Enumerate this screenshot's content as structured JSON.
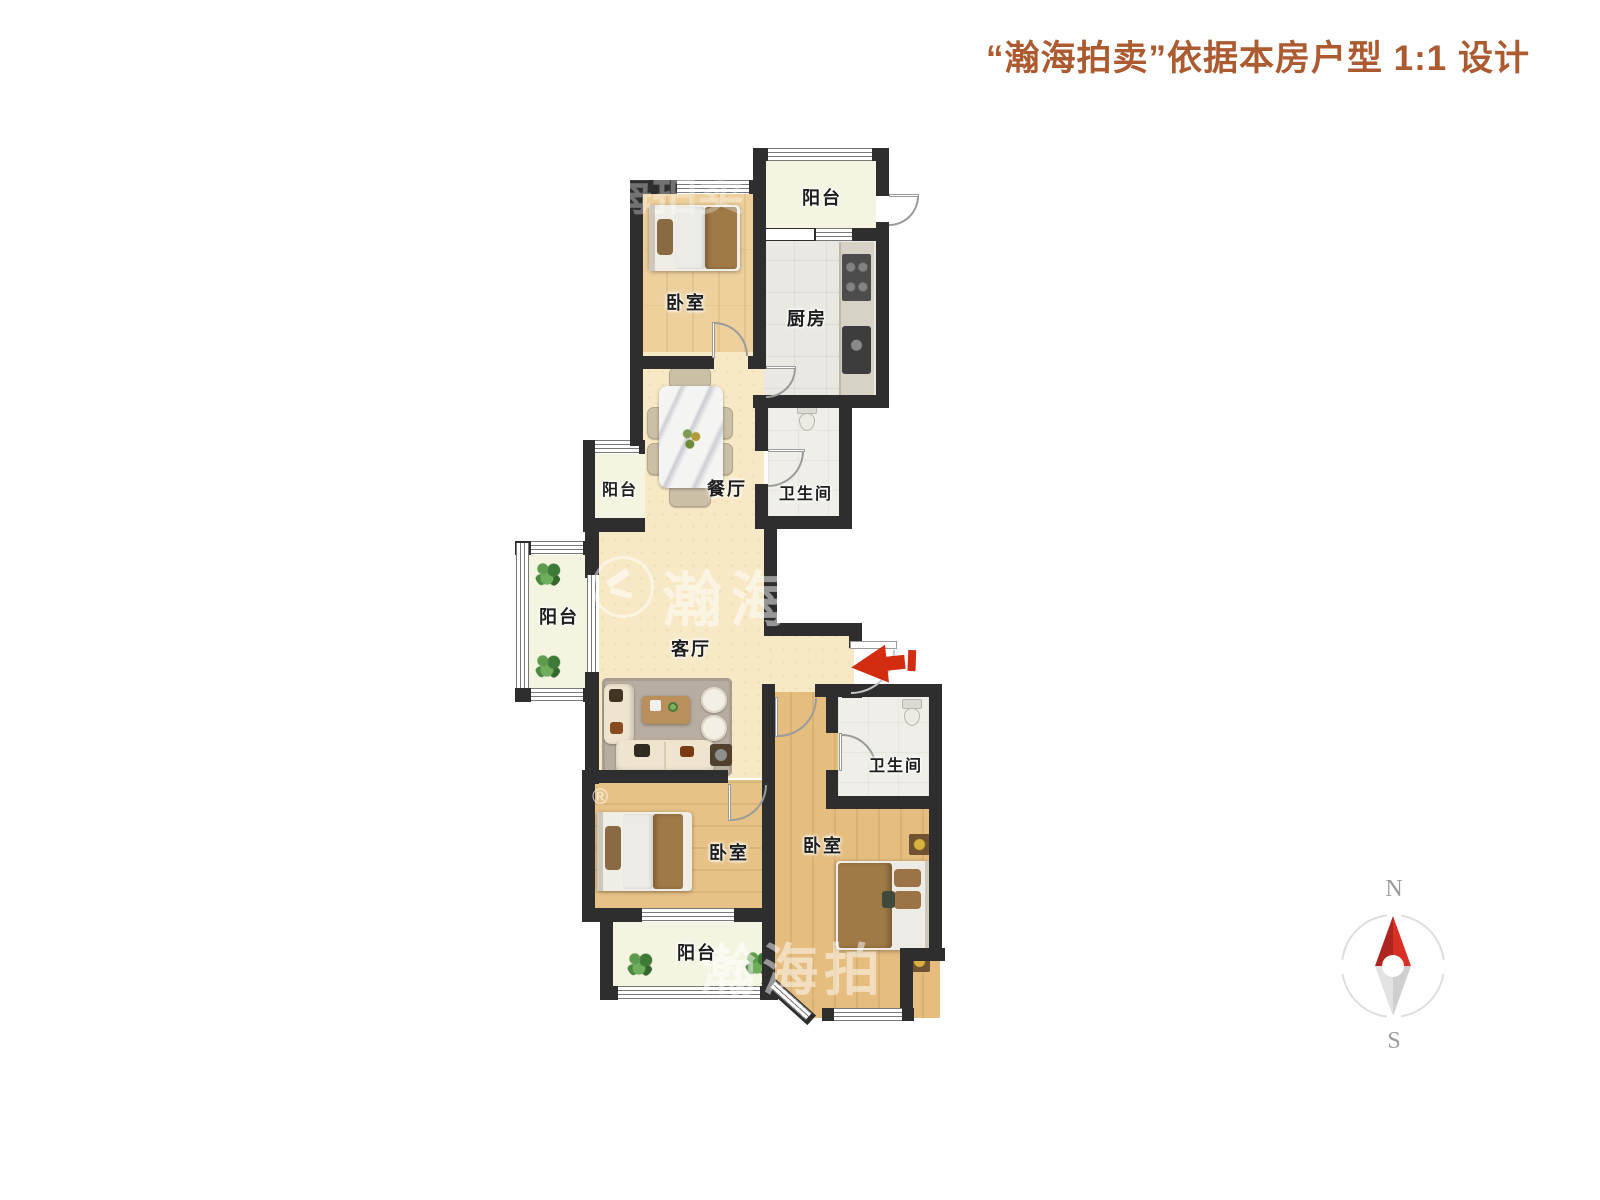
{
  "header": {
    "title": "“瀚海拍卖”依据本房户型 1:1 设计"
  },
  "rooms": [
    {
      "name": "balcony-top",
      "label": "阳台"
    },
    {
      "name": "kitchen",
      "label": "厨房"
    },
    {
      "name": "bedroom-top",
      "label": "卧室"
    },
    {
      "name": "dining-room",
      "label": "餐厅"
    },
    {
      "name": "bathroom-top",
      "label": "卫生间"
    },
    {
      "name": "balcony-dining",
      "label": "阳台"
    },
    {
      "name": "balcony-living",
      "label": "阳台"
    },
    {
      "name": "living-room",
      "label": "客厅"
    },
    {
      "name": "bathroom-bottom",
      "label": "卫生间"
    },
    {
      "name": "bedroom-bottom-left",
      "label": "卧室"
    },
    {
      "name": "bedroom-bottom-right",
      "label": "卧室"
    },
    {
      "name": "balcony-bottom",
      "label": "阳台"
    }
  ],
  "compass": {
    "north_label": "N",
    "south_label": "S"
  },
  "watermarks": {
    "logo_text": "瀚海",
    "top_fragment": "海拍卖",
    "bottom_fragment": "瀚海拍",
    "registered_mark": "®"
  },
  "colors": {
    "header_text": "#ac5a2f",
    "wall": "#2e2e2e",
    "wood_floor_light": "#eed09c",
    "wood_floor_dark": "#e5bf82",
    "cream_floor": "#f8e9c6",
    "balcony_floor": "#f4f4e1",
    "tile_floor": "#eae8e2",
    "entry_arrow_red": "#d32c10",
    "compass_needle_red": "#cf2b24"
  }
}
